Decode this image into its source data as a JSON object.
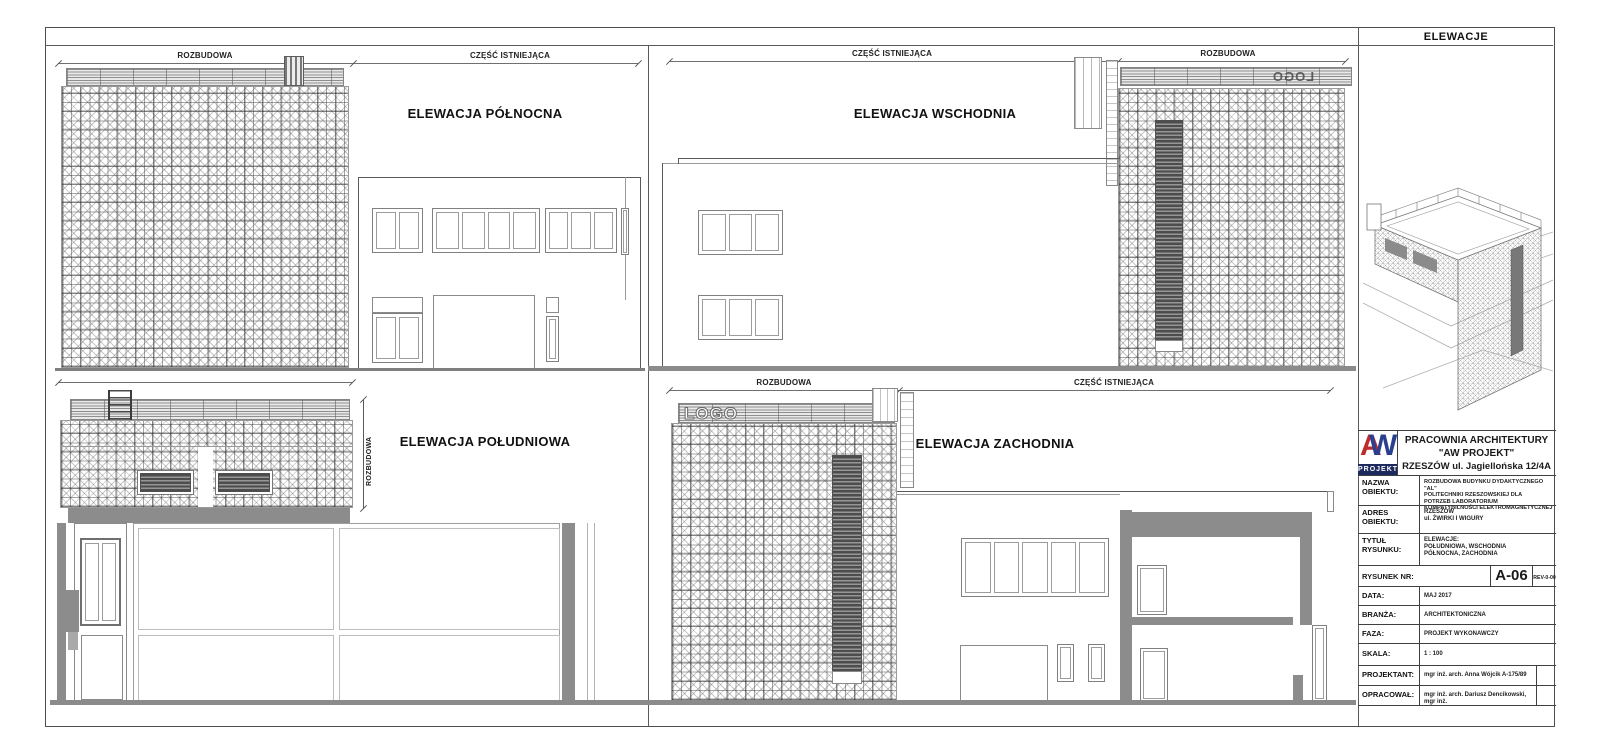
{
  "sheet_header": {
    "title": "ELEWACJE"
  },
  "elevation_titles": {
    "north": "ELEWACJA PÓŁNOCNA",
    "east": "ELEWACJA WSCHODNIA",
    "south": "ELEWACJA POŁUDNIOWA",
    "west": "ELEWACJA ZACHODNIA"
  },
  "dimension_labels": {
    "north_left": "ROZBUDOWA",
    "north_right": "CZĘŚĆ ISTNIEJĄCA",
    "east_left": "CZĘŚĆ ISTNIEJĄCA",
    "east_right": "ROZBUDOWA",
    "south_vertical": "ROZBUDOWA",
    "west_left": "ROZBUDOWA",
    "west_right": "CZĘŚĆ ISTNIEJĄCA"
  },
  "signage": {
    "west_logo": "LOGO",
    "east_logo_mirrored": "LOGO"
  },
  "titleblock": {
    "logo": {
      "letter_a": "A",
      "letter_w": "W",
      "caption": "PROJEKT",
      "color_a": "#bf2b2b",
      "color_w": "#2b3f8f",
      "band_color": "#1d2a5e"
    },
    "company": [
      "PRACOWNIA ARCHITEKTURY",
      "\"AW PROJEKT\"",
      "RZESZÓW ul. Jagiellońska 12/4A"
    ],
    "nazwa": {
      "label1": "NAZWA",
      "label2": "OBIEKTU:",
      "lines": [
        "ROZBUDOWA BUDYNKU DYDAKTYCZNEGO \"AL\"",
        "POLITECHNIKI RZESZOWSKIEJ DLA",
        "POTRZEB LABORATORIUM",
        "KOMPATYBILNOŚCI ELEKTROMAGNETYCZNEJ"
      ]
    },
    "adres": {
      "label1": "ADRES",
      "label2": "OBIEKTU:",
      "lines": [
        "RZESZÓW",
        "ul. ŻWIRKI I WIGURY"
      ]
    },
    "tytul": {
      "label1": "TYTUŁ",
      "label2": "RYSUNKU:",
      "lines": [
        "ELEWACJE:",
        "POŁUDNIOWA, WSCHODNIA",
        "PÓŁNOCNA, ZACHODNIA"
      ]
    },
    "rysunek": {
      "label": "RYSUNEK NR:",
      "number": "A-06",
      "revision": "REV-0-00"
    },
    "data_row": {
      "label": "DATA:",
      "value": "MAJ 2017"
    },
    "branza": {
      "label": "BRANŻA:",
      "value": "ARCHITEKTONICZNA"
    },
    "faza": {
      "label": "FAZA:",
      "value": "PROJEKT WYKONAWCZY"
    },
    "skala": {
      "label": "SKALA:",
      "value": "1 : 100"
    },
    "projektant": {
      "label": "PROJEKTANT:",
      "value": "mgr inż. arch. Anna Wójcik A-175/89"
    },
    "opracowal": {
      "label": "OPRACOWAŁ:",
      "value": "mgr inż. arch. Dariusz Dencikowski, mgr inż."
    }
  }
}
